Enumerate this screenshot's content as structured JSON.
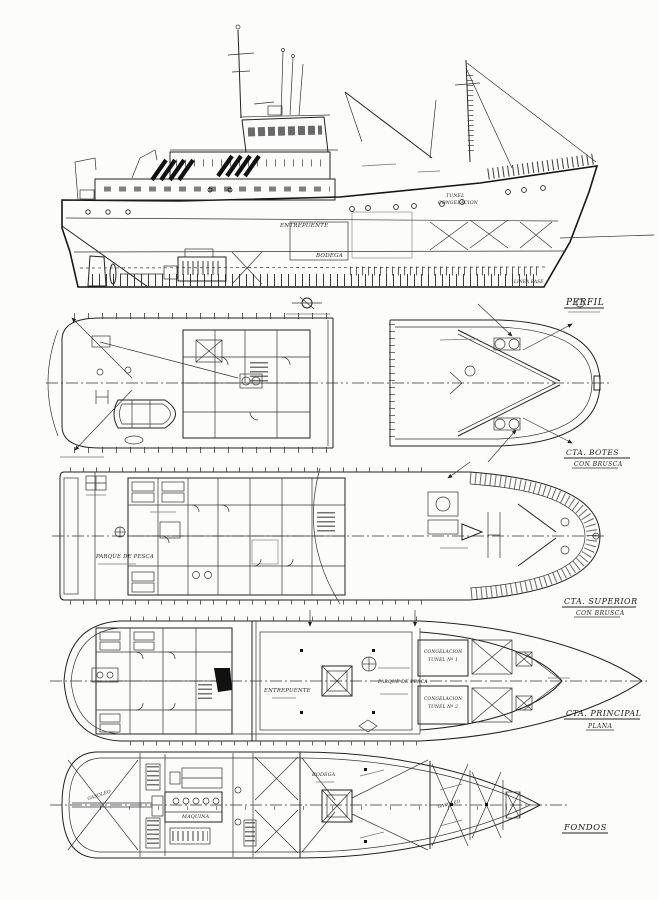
{
  "page": {
    "paper_color": "#fcfcfb",
    "ink_color": "#1f1f1f",
    "drawing_type": "general arrangement plan of a fishing trawler"
  },
  "views": {
    "perfil": {
      "title": "PERFIL",
      "entrepuente": "ENTREPUENTE",
      "bodega": "BODEGA",
      "tunel_line1": "TUNEL",
      "tunel_line2": "CONGELACION",
      "linea_base": "LINEA BASE"
    },
    "botes": {
      "title": "CTA. BOTES",
      "subtitle": "CON BRUSCA"
    },
    "superior": {
      "title": "CTA. SUPERIOR",
      "subtitle": "CON BRUSCA",
      "parque": "PARQUE DE PESCA"
    },
    "principal": {
      "title": "CTA. PRINCIPAL",
      "subtitle": "PLANA",
      "entrepuente": "ENTREPUENTE",
      "parque": "PARQUE DE PESCA",
      "tunel1_l1": "CONGELACION",
      "tunel1_l2": "TUNEL Nº 1",
      "tunel2_l1": "CONGELACION",
      "tunel2_l2": "TUNEL Nº 2"
    },
    "fondos": {
      "title": "FONDOS",
      "maquina": "MAQUINA",
      "bodega": "BODEGA",
      "gasoleo_aft": "GASOLEO",
      "gasoleo_fwd": "GASOLEO"
    }
  }
}
